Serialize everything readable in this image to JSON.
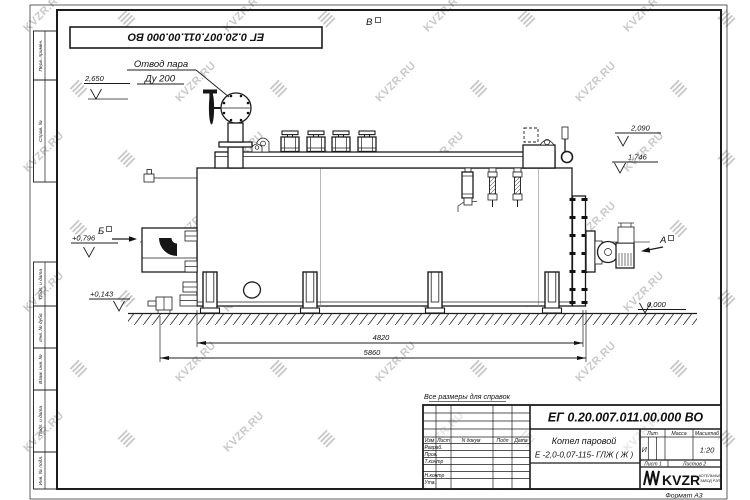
{
  "sheet": {
    "doc_number": "ЕГ 0.20.007.011.00.000  ВО",
    "watermark_text": "KVZR.RU",
    "format_label": "Формат А3",
    "reference_note": "Все размеры для справок"
  },
  "margin": {
    "labels": [
      "Перв. примен.",
      "Справ. №",
      "Подп. и дата",
      "Инв. № дубл.",
      "Взам. инв. №",
      "Подп. и дата",
      "Инв. № подл."
    ]
  },
  "drawing": {
    "steam_outlet_label_1": "Отвод пара",
    "steam_outlet_label_2": "Ду 200",
    "view_a": "А",
    "view_b": "Б",
    "view_v": "В",
    "elev_2650": "2,650",
    "elev_0796": "+0,796",
    "elev_0143": "+0,143",
    "elev_2090": "2,090",
    "elev_1746": "1,746",
    "elev_0000": "0,000",
    "dim_4820": "4820",
    "dim_5860": "5860"
  },
  "title_block": {
    "designation": "ЕГ 0.20.007.011.00.000  ВО",
    "product_name_1": "Котел паровой",
    "product_name_2": "Е -2,0-0,07-115- ГЛЖ ( Ж )",
    "col_izm": "Изм",
    "col_list": "Лист",
    "col_dokum": "N докум",
    "col_podp": "Подп",
    "col_data": "Дата",
    "role_razrab": "Разраб.",
    "role_prov": "Пров.",
    "role_tkontr": "Т.контр",
    "role_nkontr": "Н.контр",
    "role_utv": "Утв.",
    "lit_label": "Лит",
    "lit_value": "И",
    "massa_label": "Масса",
    "masshtab_label": "Масштаб",
    "masshtab_value": "1:20",
    "sheet_info": "Лист 1",
    "sheets_info": "Листов 2",
    "logo_text": "KVZR",
    "logo_sub_1": "КОТЕЛЬНЫЙ",
    "logo_sub_2": "ЗАВОД РЭП"
  }
}
